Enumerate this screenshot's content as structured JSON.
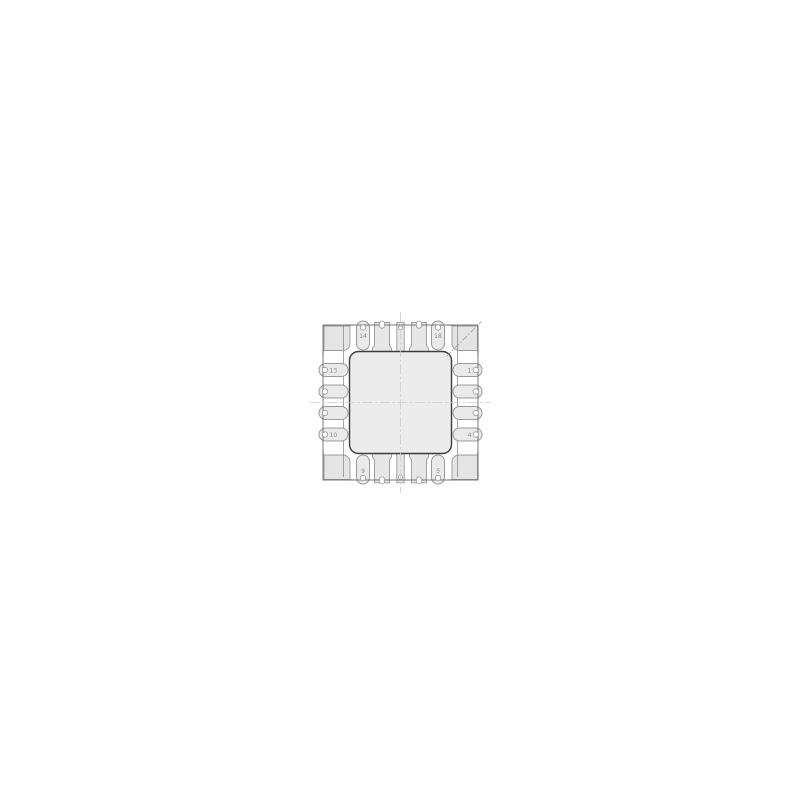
{
  "drawing": {
    "pin_labels": {
      "left_top": "13",
      "left_bottom": "10",
      "top_left": "14",
      "top_right": "18",
      "right_top": "1",
      "right_bottom": "4",
      "bottom_left": "9",
      "bottom_right": "5"
    }
  },
  "colors": {
    "background": "#ffffff",
    "land_fill": "#eaeaea",
    "pad_fill": "#e7e7e7",
    "corner_fill": "#e4e4e4",
    "center_fill": "#ececec",
    "pad_stroke": "#9a9a9a",
    "outline_stroke": "#6a6a6a",
    "center_stroke": "#3c3c3c",
    "arc_stroke": "#8a8a8a",
    "edge_stroke": "#8f8f8f",
    "centerline_stroke": "#cdcdcd",
    "chamfer_stroke": "#9a9a9a",
    "label_color": "#8a8a8a"
  }
}
